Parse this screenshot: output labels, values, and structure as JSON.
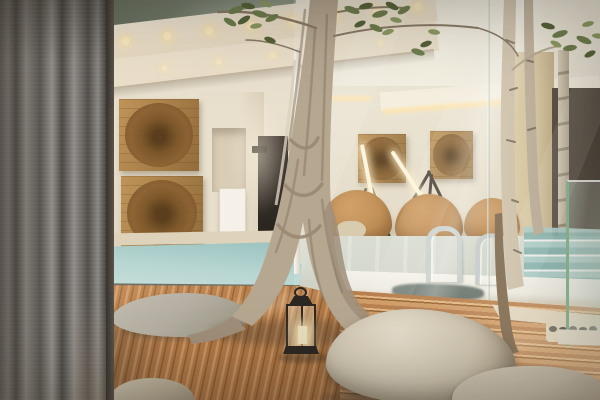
{
  "scene": {
    "type": "photograph",
    "setting": "Spa courtyard: timber deck with tree and boulders in front of a glass-walled indoor pool lounge, sheer grey curtain at left",
    "objects": [
      "grey sheer curtain",
      "dark clerestory window reflecting trees",
      "cream soffit with recessed warm lights",
      "two stacked square wooden artworks with carved circular discs",
      "wall niche with white radiator panel",
      "dark doorway",
      "black wall sconce",
      "glass wall with white mullion and reflections",
      "lounge room with two framed disc artworks",
      "two tripod tube floor lamps",
      "tan rattan lounge chairs and side table",
      "indoor pool with white coping and two steel handrails",
      "teal pool steps behind glass",
      "beige and dark wall panels",
      "outdoor plunge pool with pale aqua water and stone coping",
      "reddish timber deck, diagonal and horizontal planks",
      "cream stone border with pebble-filled tree cutout",
      "flat grey stone",
      "large beige boulder and smaller stones",
      "black candle lantern",
      "central ficus trunk with aerial roots and vines",
      "slender birch trunks and thin sapling",
      "green leaf canopy at top",
      "green-edged glass balustrade at right"
    ]
  },
  "palette": {
    "curtain_dark": "#53504c",
    "curtain_mid": "#7d7a75",
    "curtain_light": "#a29e99",
    "frame_edge": "#3e3934",
    "wall": "#e8dfcd",
    "wall_shadow": "#d6cab5",
    "clerestory": "#67705f",
    "clerestory_reflection": "#aab3a2",
    "fascia": "#f4ead8",
    "soffit": "#ece0ca",
    "recessed_light": "#ffedc2",
    "art_frame": "#bf9459",
    "art_frame_dark": "#926c3a",
    "art_disc": "#8a6132",
    "art_disc_core": "#54381a",
    "doorway": "#342e28",
    "sconce": "#2b2620",
    "radiator": "#f5f1e8",
    "cove_glow": "#ffe5ae",
    "bulkhead": "#f6efdf",
    "interior_wall": "#eae1cf",
    "chair": "#bf8a4f",
    "chair_dark": "#996a38",
    "side_table": "#d9c9ab",
    "interior_floor": "#d6d8cd",
    "beige_panel": "#d7c49e",
    "dark_panel": "#453a2f",
    "teal_step": "#83b3ae",
    "teal_step_light": "#a9cdc7",
    "pool_coping": "#efece2",
    "pool_water_shadow": "#5d6962",
    "rail": "#c9cfca",
    "plunge_water": "#b7d5d1",
    "plunge_water_deep": "#96c0bc",
    "plunge_coping": "#ded2bb",
    "deck": "#b67c4a",
    "deck_dark": "#95612f",
    "deck_light": "#cf9a64",
    "deck_pale": "#e2b582",
    "stone_border": "#e8ddc6",
    "pebble": "#7e7a70",
    "flat_stone": "#b4afa2",
    "boulder": "#cfc5b1",
    "boulder_shadowside": "#a2937c",
    "boulder_light": "#e6ddcb",
    "stone_small": "#c6bcaa",
    "trunk": "#b6a791",
    "trunk_dark": "#8b7b68",
    "trunk_light": "#dcd1bf",
    "root": "#a08f7a",
    "vine": "#9a8a74",
    "birch": "#d4c8b3",
    "birch_dark": "#c2b5a0",
    "birch_mark": "#6f6354",
    "sapling": "#8d7960",
    "leaf": "#6e7e4d",
    "leaf_dark": "#556238",
    "leaf_light": "#8d9c63",
    "lantern": "#2c2722",
    "candle": "#eadfbd",
    "glass_edge_green": "#8fba96",
    "tube_light": "#fff5dc",
    "lamp_leg": "#463c30"
  }
}
